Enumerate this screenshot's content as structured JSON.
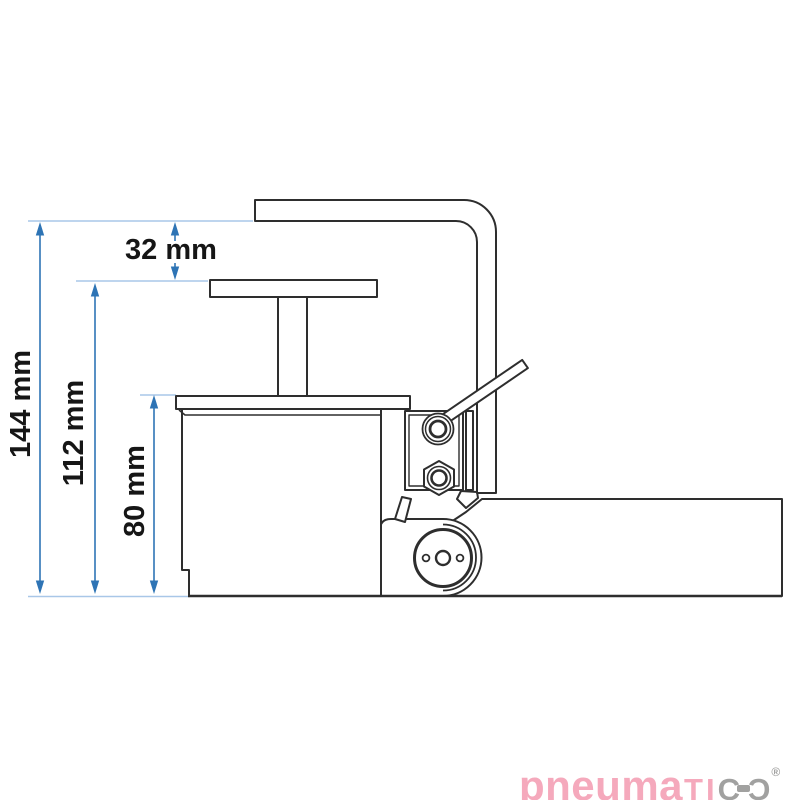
{
  "diagram": {
    "type": "technical-drawing",
    "subject": "toe jack side view with height dimensions",
    "dimensions": {
      "total_height": "144 mm",
      "saddle_height": "112 mm",
      "body_height": "80 mm",
      "top_offset": "32 mm"
    },
    "colors": {
      "dimension_line": "#2e74b5",
      "extension_line": "#a9c7e8",
      "outline": "#2e2e2e",
      "label_text": "#161616"
    }
  },
  "logo": {
    "brand": "pneumatico",
    "part_lower": "pneuma",
    "part_caps": "TI",
    "part_c": "C",
    "registered": "®",
    "pink": "#f5a9bc",
    "gray": "#a1a1a0"
  }
}
